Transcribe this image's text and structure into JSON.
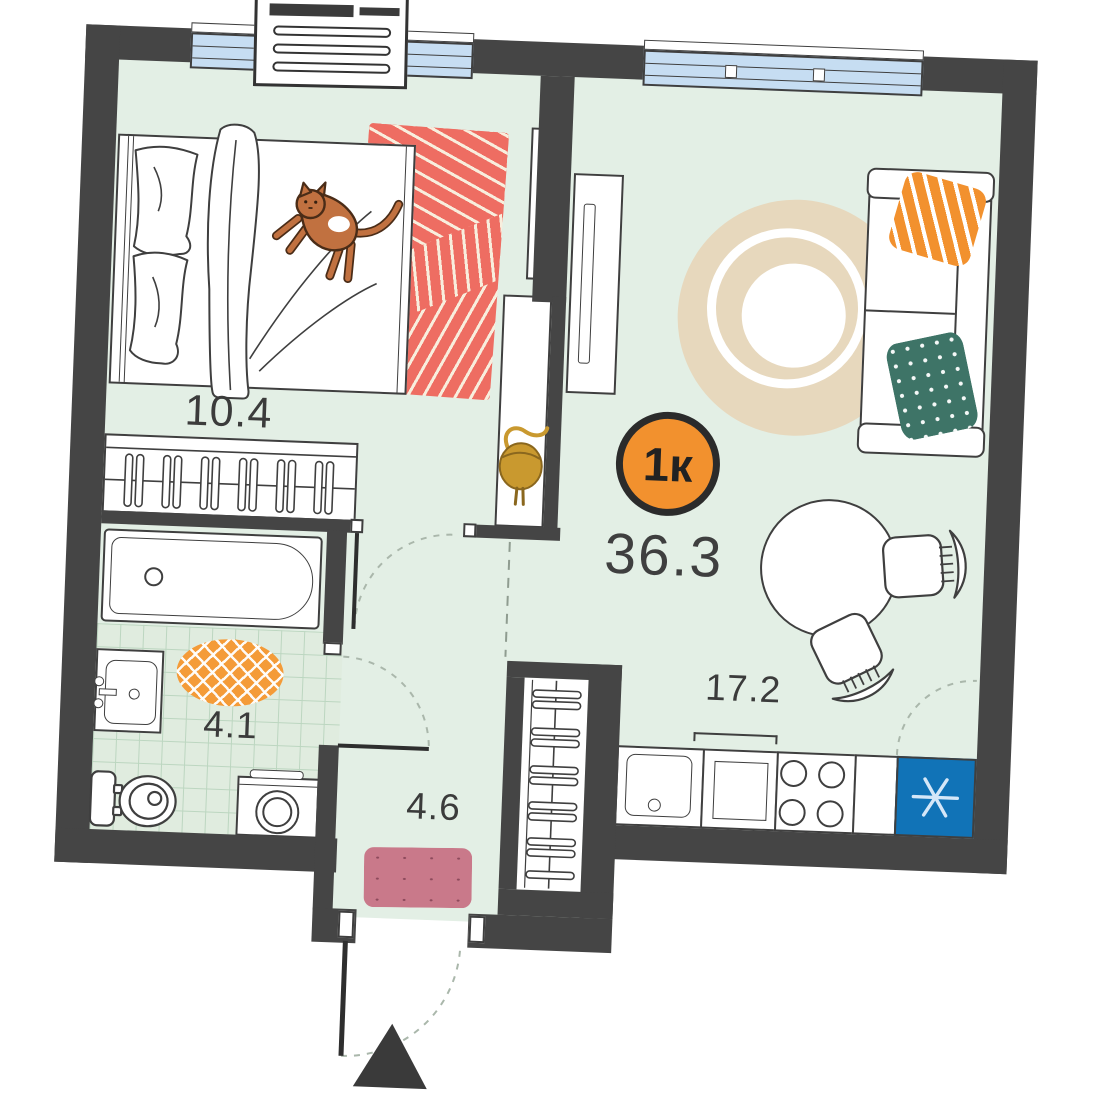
{
  "floorplan": {
    "badge_label": "1к",
    "total_area": "36.3",
    "rooms": {
      "bedroom": {
        "area": "10.4"
      },
      "living_kitchen": {
        "area": "17.2"
      },
      "bathroom": {
        "area": "4.1"
      },
      "hallway": {
        "area": "4.6"
      }
    },
    "icons": [
      "bed-icon",
      "cat-icon",
      "wardrobe-hangers-icon",
      "bathtub-icon",
      "sink-icon",
      "toilet-icon",
      "washing-machine-icon",
      "sofa-icon",
      "tv-icon",
      "mirror-icon",
      "console-table-icon",
      "handbag-icon",
      "dining-table-icon",
      "chair-icon",
      "kitchen-sink-icon",
      "stove-icon",
      "fridge-snowflake-icon",
      "window-icon",
      "air-conditioner-icon",
      "entrance-arrow-icon",
      "door-swing-icon",
      "round-rug-icon",
      "striped-rug-icon",
      "bath-mat-icon",
      "door-mat-icon",
      "pillow-icon"
    ],
    "colors": {
      "wall": "#454545",
      "floor": "#e3efe5",
      "tile_line": "#bcd6c0",
      "window_glass": "#c6ddf2",
      "badge": "#f2912e",
      "area_text": "#3b3b3b",
      "coral_rug": "#ee6d62",
      "orange_rug": "#f49b38",
      "beige_rug": "#e7d8bd",
      "pink_mat": "#c9798a",
      "green_pillow": "#3e7467",
      "orange_pillow": "#f2912e",
      "fridge": "#1173b7",
      "cat": "#c17140",
      "bag_gold": "#c9992f"
    }
  }
}
